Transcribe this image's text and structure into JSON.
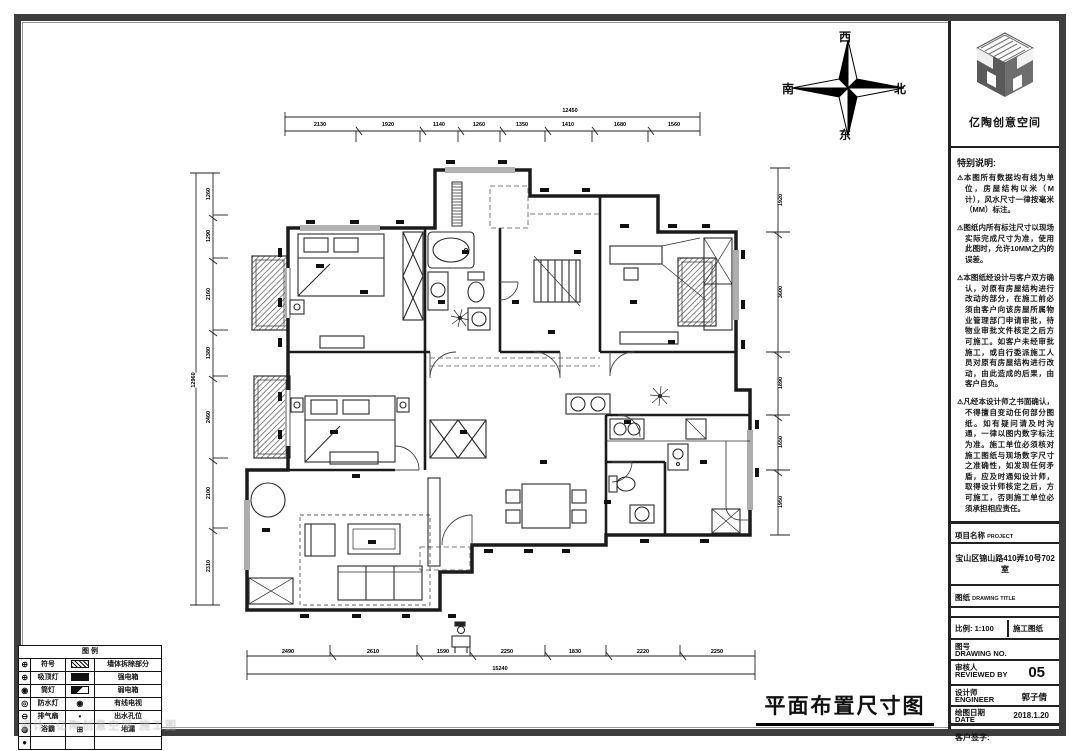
{
  "logo": {
    "brand": "亿陶创意空间"
  },
  "compass": {
    "top": "西",
    "left": "南",
    "right": "北",
    "bottom": "东"
  },
  "notes": {
    "title": "特别说明:",
    "items": [
      "本图所有数据均有线为单位，房屋结构以米（M 计），风水尺寸一律按毫米（MM）标注。",
      "图纸内所有标注尺寸以现场实际完成尺寸为准，使用此图时，允许10MM之内的误差。",
      "本图纸经设计与客户双方确认，对原有房屋结构进行改动的部分，在施工前必须由客户向该房屋所属物业管理部门申请审批，待物业审批文件核定之后方可施工。如客户未经审批施工，或自行委派施工人员对原有房屋结构进行改动，由此造成的后果，由客户自负。",
      "凡经本设计师之书面确认，不得擅自变动任何部分图纸。如有疑问请及时沟通，一律以图内数字标注为准。施工单位必须核对施工图纸与现场数字尺寸之准确性，如发现任何矛盾，应及时通知设计师，取得设计师核定之后，方可施工，否则施工单位必须承担相应责任。"
    ]
  },
  "titleblock": {
    "project_label": "项目名称",
    "project_label_en": "PROJECT",
    "project_value": "宝山区锦山路410弄10号702室",
    "drawing_label": "图纸",
    "drawing_label_en": "DRAWING TITLE",
    "scale_label": "比例:",
    "scale_value": "1:100",
    "phase_value": "施工图纸",
    "no_label": "图号",
    "no_label_en": "DRAWING NO.",
    "reviewer_label": "审核人",
    "reviewer_label_en": "REVIEWED BY",
    "reviewer_value": "05",
    "designer_label": "设计师",
    "designer_label_en": "ENGINEER",
    "designer_value": "郭子倩",
    "date_label": "绘图日期",
    "date_label_en": "DATE",
    "date_value": "2018.1.20",
    "signature_label": "客户签字:"
  },
  "legend": {
    "title": "图  例",
    "rows": [
      [
        {
          "sym": "target"
        },
        {
          "txt": "符号"
        },
        {
          "sym": "hatch"
        },
        {
          "txt": "墙体拆除部分"
        }
      ],
      [
        {
          "sym": "target"
        },
        {
          "txt": "吸顶灯"
        },
        {
          "sym": "solid"
        },
        {
          "txt": "强电箱"
        }
      ],
      [
        {
          "sym": "spot"
        },
        {
          "txt": "筒灯"
        },
        {
          "sym": "half"
        },
        {
          "txt": "弱电箱"
        }
      ],
      [
        {
          "sym": "ring"
        },
        {
          "txt": "防水灯"
        },
        {
          "sym": "spot"
        },
        {
          "txt": "有线电视"
        }
      ],
      [
        {
          "sym": "fan"
        },
        {
          "txt": "排气扇"
        },
        {
          "sym": "dot"
        },
        {
          "txt": "出水孔位"
        }
      ],
      [
        {
          "sym": "bath"
        },
        {
          "txt": "浴霸"
        },
        {
          "sym": "grid"
        },
        {
          "txt": "地漏"
        }
      ],
      [
        {
          "sym": "filled"
        },
        {
          "txt": ""
        },
        {
          "sym": "none"
        },
        {
          "txt": ""
        }
      ]
    ],
    "header_cols": [
      "符号",
      "名 称"
    ]
  },
  "plan": {
    "title": "平面布置尺寸图"
  },
  "watermark": "设计©亿陶创意空间 施工图",
  "dims": {
    "labels": [
      {
        "x": 570,
        "y": 111,
        "t": "12450",
        "rot": false
      },
      {
        "x": 320,
        "y": 125,
        "t": "2130",
        "rot": false
      },
      {
        "x": 388,
        "y": 125,
        "t": "1920",
        "rot": false
      },
      {
        "x": 439,
        "y": 125,
        "t": "1140",
        "rot": false
      },
      {
        "x": 479,
        "y": 125,
        "t": "1260",
        "rot": false
      },
      {
        "x": 522,
        "y": 125,
        "t": "1350",
        "rot": false
      },
      {
        "x": 568,
        "y": 125,
        "t": "1410",
        "rot": false
      },
      {
        "x": 620,
        "y": 125,
        "t": "1680",
        "rot": false
      },
      {
        "x": 674,
        "y": 125,
        "t": "1560",
        "rot": false
      },
      {
        "x": 194,
        "y": 380,
        "t": "12960",
        "rot": true
      },
      {
        "x": 209,
        "y": 194,
        "t": "1260",
        "rot": true
      },
      {
        "x": 209,
        "y": 236,
        "t": "1290",
        "rot": true
      },
      {
        "x": 209,
        "y": 294,
        "t": "2160",
        "rot": true
      },
      {
        "x": 209,
        "y": 353,
        "t": "1380",
        "rot": true
      },
      {
        "x": 209,
        "y": 417,
        "t": "2460",
        "rot": true
      },
      {
        "x": 209,
        "y": 493,
        "t": "2100",
        "rot": true
      },
      {
        "x": 209,
        "y": 566,
        "t": "2310",
        "rot": true
      },
      {
        "x": 781,
        "y": 200,
        "t": "1920",
        "rot": true
      },
      {
        "x": 781,
        "y": 292,
        "t": "3600",
        "rot": true
      },
      {
        "x": 781,
        "y": 383,
        "t": "1890",
        "rot": true
      },
      {
        "x": 781,
        "y": 442,
        "t": "1650",
        "rot": true
      },
      {
        "x": 781,
        "y": 502,
        "t": "1950",
        "rot": true
      },
      {
        "x": 288,
        "y": 652,
        "t": "2490",
        "rot": false
      },
      {
        "x": 373,
        "y": 652,
        "t": "2610",
        "rot": false
      },
      {
        "x": 443,
        "y": 652,
        "t": "1590",
        "rot": false
      },
      {
        "x": 507,
        "y": 652,
        "t": "2250",
        "rot": false
      },
      {
        "x": 575,
        "y": 652,
        "t": "1830",
        "rot": false
      },
      {
        "x": 643,
        "y": 652,
        "t": "2220",
        "rot": false
      },
      {
        "x": 717,
        "y": 652,
        "t": "2250",
        "rot": false
      },
      {
        "x": 500,
        "y": 669,
        "t": "15240",
        "rot": false
      }
    ]
  }
}
